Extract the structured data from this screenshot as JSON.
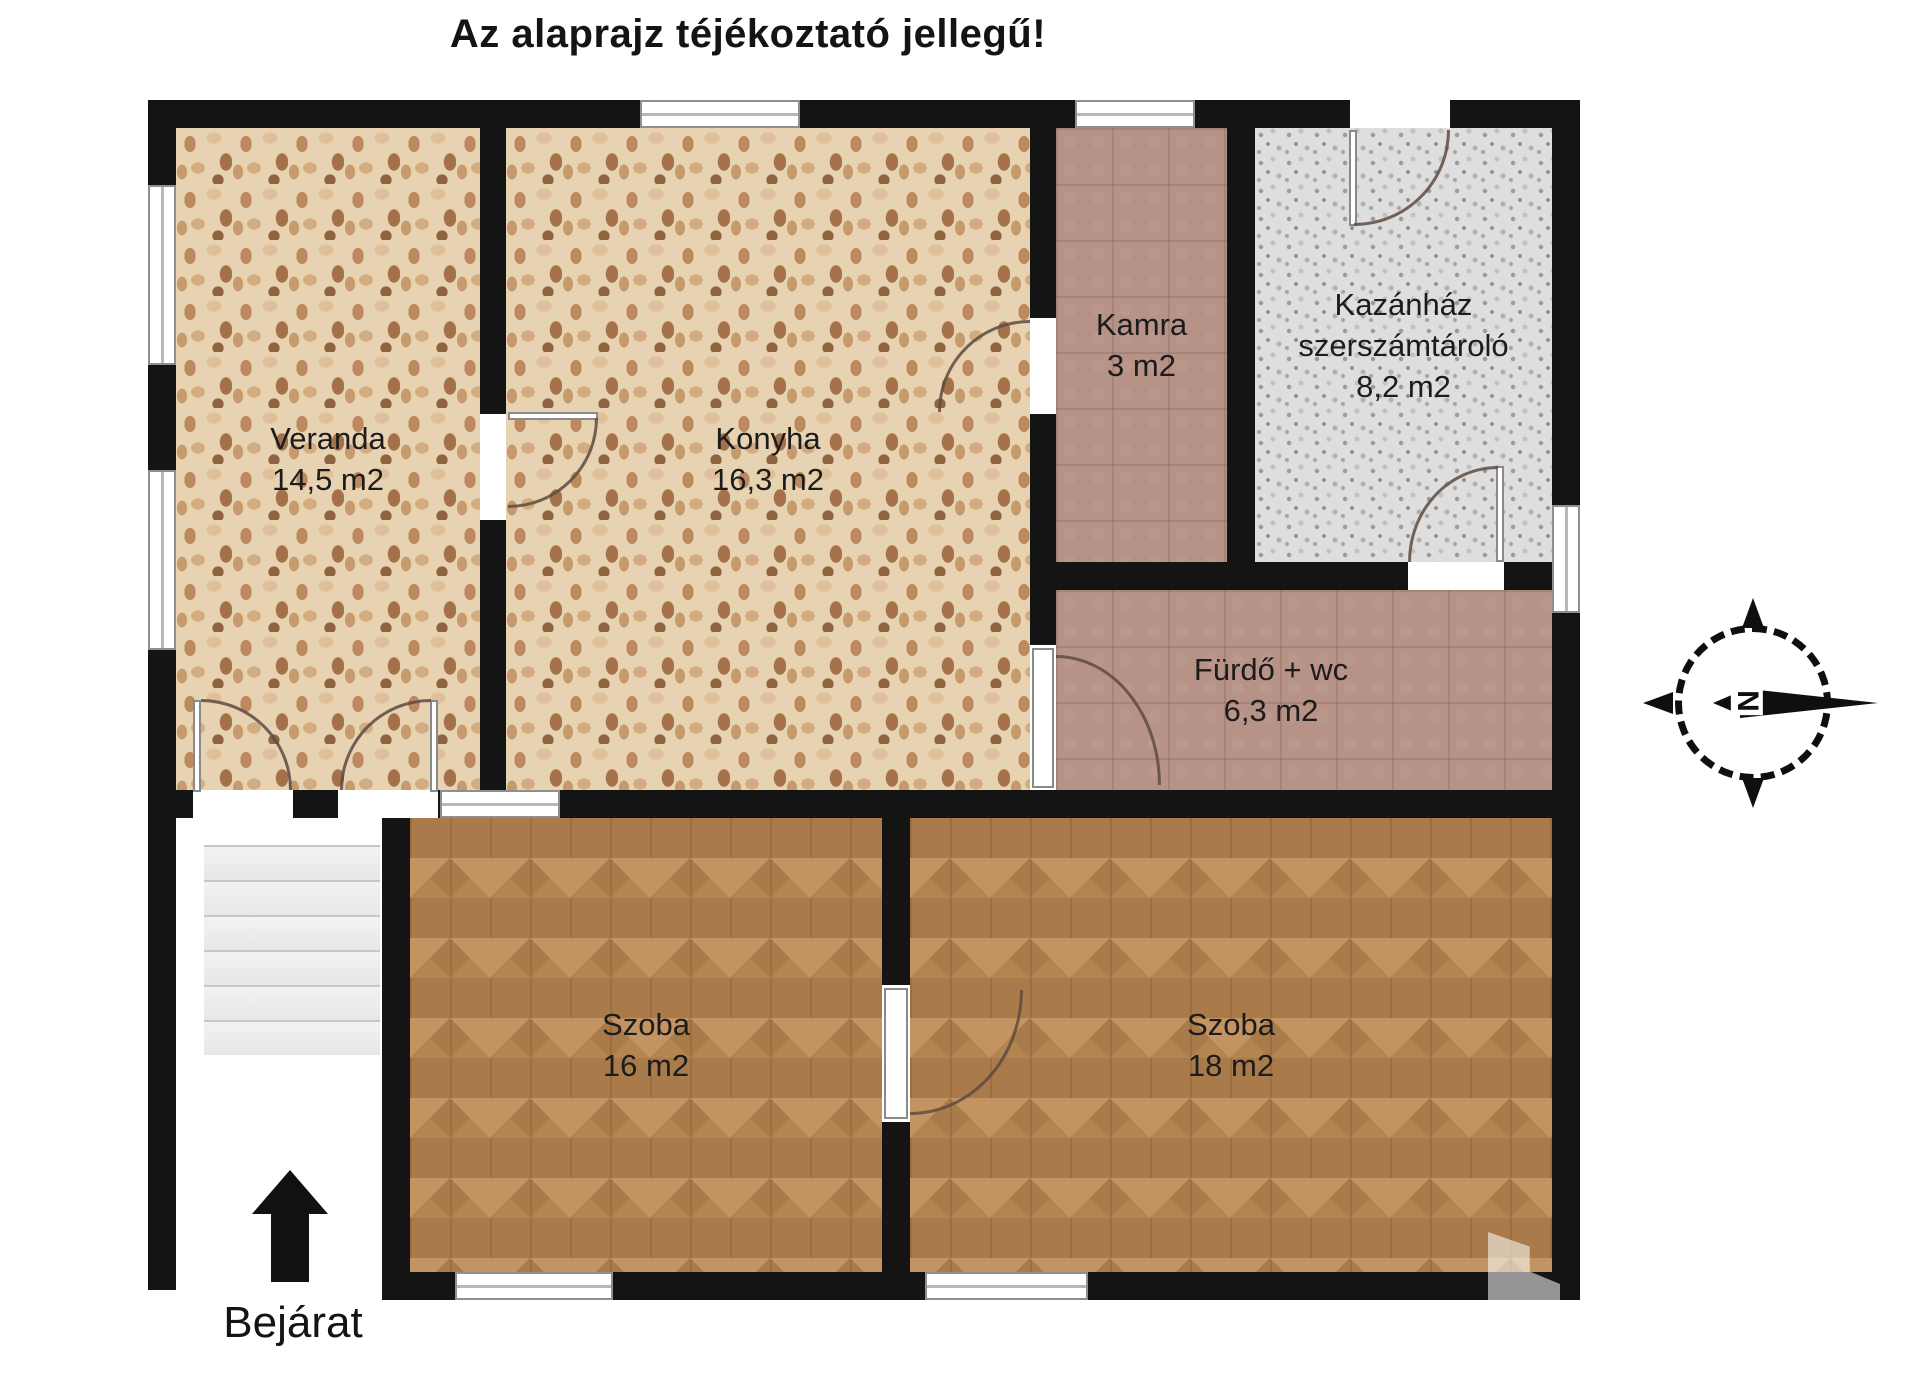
{
  "title": "Az alaprajz téjékoztató jellegű!",
  "entrance": {
    "label": "Bejárat"
  },
  "compass": {
    "north_letter": "N"
  },
  "rooms": {
    "veranda": {
      "name": "Veranda",
      "area": "14,5 m2"
    },
    "konyha": {
      "name": "Konyha",
      "area": "16,3 m2"
    },
    "kamra": {
      "name": "Kamra",
      "area": "3 m2"
    },
    "kazanhaz": {
      "name": "Kazánház",
      "name2": "szerszámtároló",
      "area": "8,2 m2"
    },
    "furdo": {
      "name": "Fürdő + wc",
      "area": "6,3 m2"
    },
    "szoba1": {
      "name": "Szoba",
      "area": "16 m2"
    },
    "szoba2": {
      "name": "Szoba",
      "area": "18 m2"
    }
  },
  "colors": {
    "wall": "#141414",
    "mosaic_floor": "#e7d2b2",
    "tile_floor": "#b79286",
    "boiler_floor": "#dedede",
    "wood_floor": "#a97a4a"
  }
}
